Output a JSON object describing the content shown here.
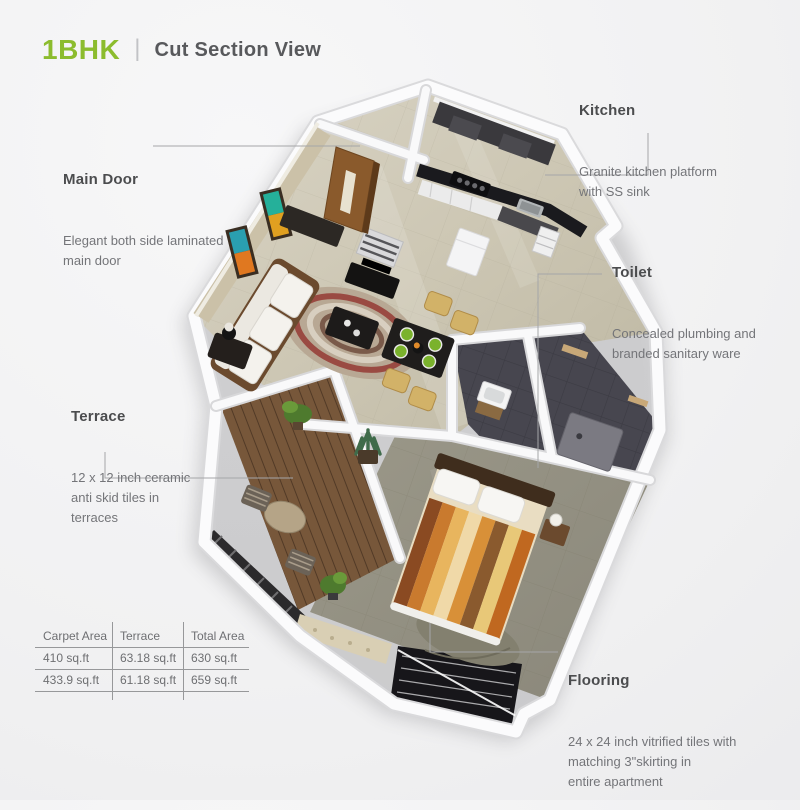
{
  "header": {
    "title": "1BHK",
    "divider": "|",
    "subtitle": "Cut Section View"
  },
  "annotations": {
    "main_door": {
      "heading": "Main Door",
      "body": "Elegant both side laminated\nmain door"
    },
    "kitchen": {
      "heading": "Kitchen",
      "body": "Granite kitchen platform\nwith SS sink"
    },
    "toilet": {
      "heading": "Toilet",
      "body": "Concealed plumbing and\nbranded sanitary ware"
    },
    "terrace": {
      "heading": "Terrace",
      "body": "12 x 12 inch ceramic\nanti skid tiles in\nterraces"
    },
    "flooring": {
      "heading": "Flooring",
      "body": "24 x 24 inch vitrified tiles with\nmatching 3\"skirting in\nentire apartment"
    }
  },
  "area_table": {
    "headers": [
      "Carpet Area",
      "Terrace",
      "Total Area"
    ],
    "rows": [
      [
        "410 sq.ft",
        "63.18 sq.ft",
        "630 sq.ft"
      ],
      [
        "433.9 sq.ft",
        "61.18 sq.ft",
        "659 sq.ft"
      ]
    ]
  },
  "colors": {
    "accent_green": "#8cbc2e",
    "heading_text": "#4b4c4e",
    "body_text": "#747579",
    "leader_line": "#a5a6a8"
  }
}
